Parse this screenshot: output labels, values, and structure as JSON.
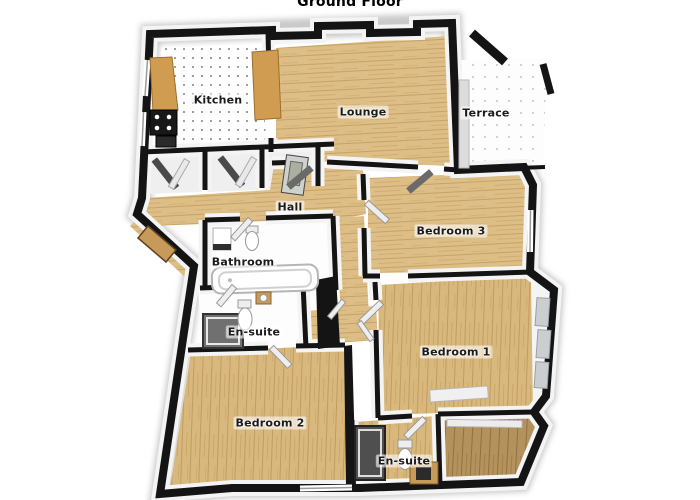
{
  "title": "Ground Floor",
  "floorplan": {
    "rooms": [
      {
        "label": "Kitchen"
      },
      {
        "label": "Lounge"
      },
      {
        "label": "Terrace"
      },
      {
        "label": "Hall"
      },
      {
        "label": "Bedroom 3"
      },
      {
        "label": "Bathroom"
      },
      {
        "label": "En-suite"
      },
      {
        "label": "Bedroom 1"
      },
      {
        "label": "Bedroom 2"
      },
      {
        "label": "En-suite"
      }
    ],
    "colors": {
      "wall": "#141414",
      "wall_face": "#f4f4f4",
      "wood_light": "#ddbe86",
      "wood_grain": "#c6a266",
      "wood_dark": "#b3925e",
      "tile_white": "#ffffff",
      "counter_wood": "#cf9c51",
      "fixture_white": "#fdfdfd",
      "shower_dark": "#585858",
      "window_pane": "#c9ced1"
    }
  }
}
